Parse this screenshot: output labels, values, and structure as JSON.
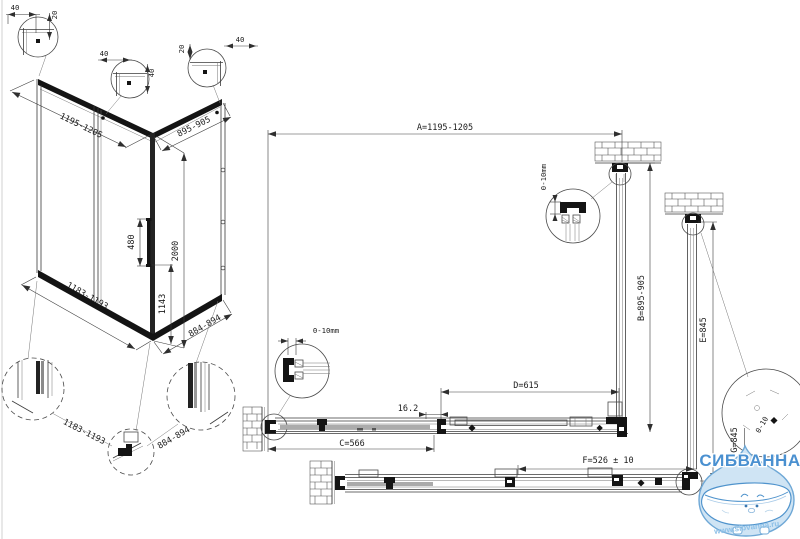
{
  "drawing": {
    "iso": {
      "width": "1195-1205",
      "side": "895-905",
      "height": "2000",
      "handle_len": "480",
      "handle_h": "1143",
      "bottom_width": "1183-1193",
      "bottom_side": "884-894"
    },
    "corner_details": {
      "d1_h": "40",
      "d1_v": "20",
      "d2_h": "40",
      "d2_v": "40",
      "d3_v": "20",
      "d3_h": "40"
    },
    "bottom_details": {
      "front": "1183-1193",
      "side": "884-894"
    },
    "plan": {
      "A": "A=1195-1205",
      "B": "B=895-905",
      "C": "C=566",
      "D": "D=615",
      "E": "E=845",
      "F": "F=526 ± 10",
      "G": "G=845",
      "overlap": "16.2",
      "adjust_top": "0-10mm",
      "adjust_left": "0-10mm",
      "adjust_mag": "0-10"
    }
  },
  "logo": {
    "brand": "СИБВАННА",
    "url": "www.sibvanna.ru"
  }
}
